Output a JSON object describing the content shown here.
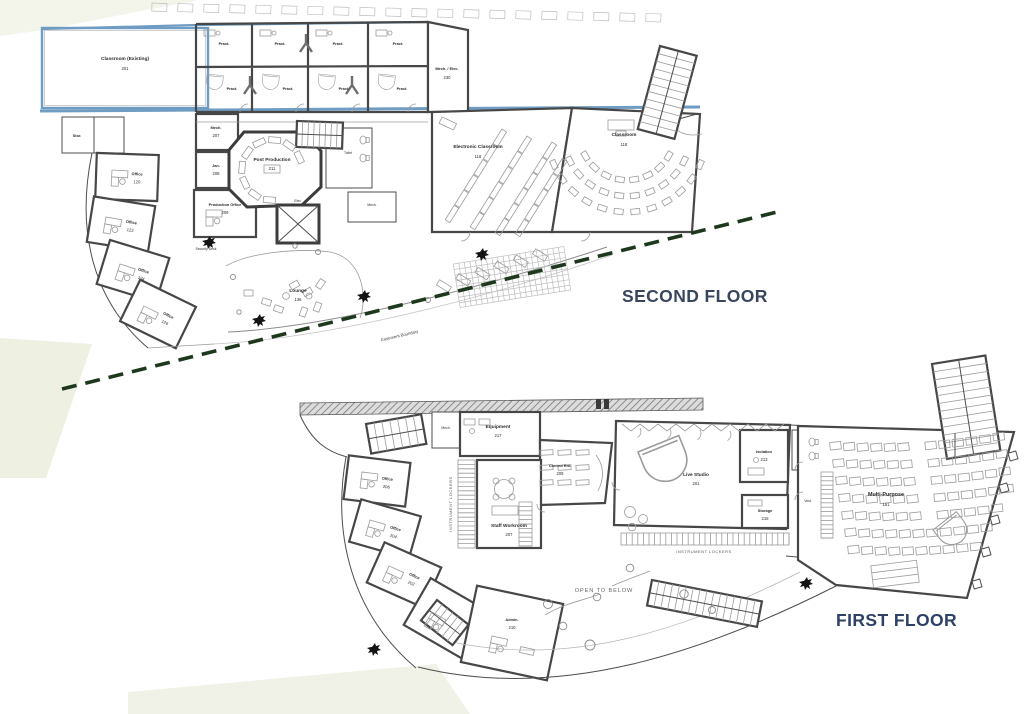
{
  "colors": {
    "floor_label_second": "#3a455e",
    "floor_label_first": "#2e4167",
    "existing_wall_blue": "#6f9cc2",
    "easement_green": "#1e381e",
    "wall_gray": "#474747"
  },
  "floor2": {
    "title": "SECOND FLOOR",
    "easement_label": "Easement Boundary",
    "security_desk": "Security Desk",
    "rooms": {
      "classroom_existing": {
        "label": "Classroom (Existing)",
        "num": "201"
      },
      "pract": {
        "label": "Pract."
      },
      "mech_elec": {
        "label": "Mech. / Elec.",
        "num": "230"
      },
      "stor": {
        "label": "Stor."
      },
      "post_production": {
        "label": "Post Production",
        "num": "211"
      },
      "mech": {
        "label": "Mech.",
        "num": "207"
      },
      "jan": {
        "label": "Jan.",
        "num": "208"
      },
      "production_office": {
        "label": "Production Office",
        "num": "209"
      },
      "elev": {
        "label": "Elev."
      },
      "toilet": {
        "label": "Toilet"
      },
      "mech2": {
        "label": "Mech."
      },
      "electronic_classroom": {
        "label": "Electronic Classroom",
        "num": "116"
      },
      "classroom": {
        "label": "Classroom",
        "num": "118"
      },
      "lounge": {
        "label": "Lounge",
        "num": "136"
      },
      "office1": {
        "label": "Office",
        "num": "120"
      },
      "office2": {
        "label": "Office",
        "num": "122"
      },
      "office3": {
        "label": "Office",
        "num": "124"
      },
      "office4": {
        "label": "Office",
        "num": "126"
      }
    }
  },
  "floor1": {
    "title": "FIRST FLOOR",
    "open_to_below": "OPEN TO BELOW",
    "instrument_lockers": "INSTRUMENT LOCKERS",
    "rooms": {
      "mech": {
        "label": "Mech."
      },
      "equipment": {
        "label": "Equipment",
        "num": "217"
      },
      "control": {
        "label": "Control Rm.",
        "num": "209"
      },
      "staff_workroom": {
        "label": "Staff Workroom",
        "num": "207"
      },
      "live_studio": {
        "label": "Live Studio",
        "num": "201"
      },
      "isolation": {
        "label": "Isolation",
        "num": "213"
      },
      "storage": {
        "label": "Storage",
        "num": "215"
      },
      "vest": {
        "label": "Vest."
      },
      "multi_purpose": {
        "label": "Multi-Purpose",
        "num": "151"
      },
      "office1": {
        "label": "Office",
        "num": "206"
      },
      "office2": {
        "label": "Office",
        "num": "204"
      },
      "office3": {
        "label": "Office",
        "num": "202"
      },
      "dept_head": {
        "label": "Department Head",
        "num": "200"
      },
      "admin": {
        "label": "Admin.",
        "num": "210"
      }
    }
  }
}
